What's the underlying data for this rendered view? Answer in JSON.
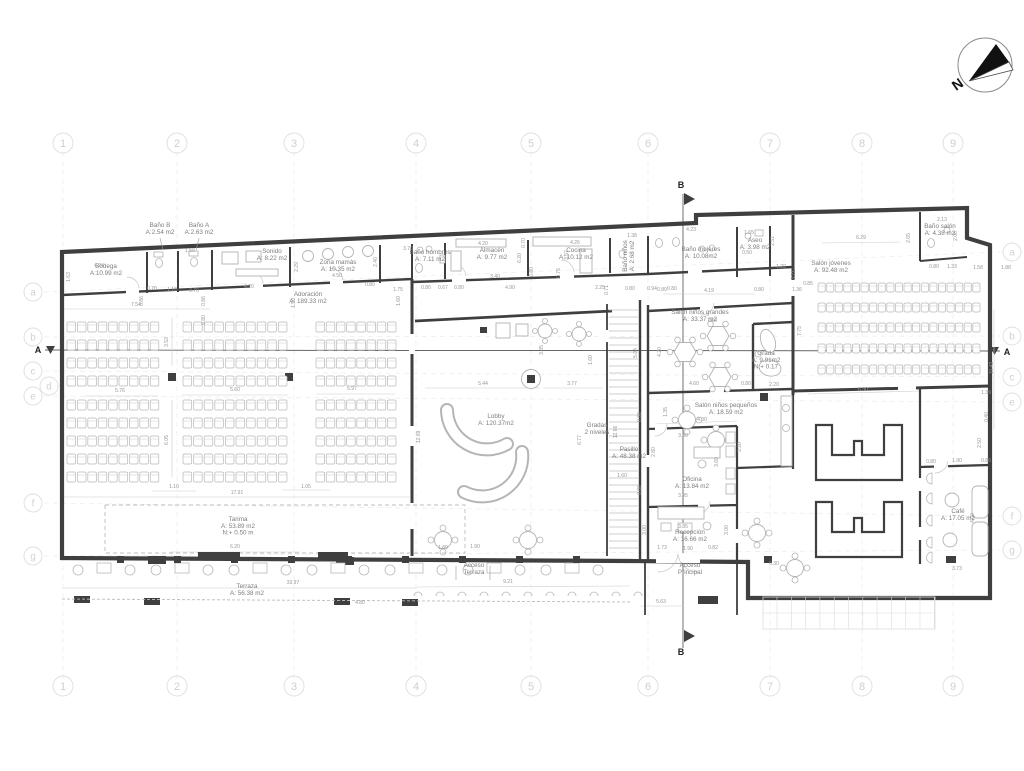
{
  "meta": {
    "wall_color": "#3f3f3f",
    "furniture_color": "#b3b3b3",
    "label_color": "#7d7d7d",
    "dimension_color": "#969696",
    "grid_color": "#e9e9e9"
  },
  "compass": {
    "label": "N"
  },
  "sections": {
    "a": "A",
    "b": "B"
  },
  "grid": {
    "columns": [
      {
        "n": "1",
        "x": 63
      },
      {
        "n": "2",
        "x": 177
      },
      {
        "n": "3",
        "x": 294
      },
      {
        "n": "4",
        "x": 416
      },
      {
        "n": "5",
        "x": 531
      },
      {
        "n": "6",
        "x": 648
      },
      {
        "n": "7",
        "x": 770
      },
      {
        "n": "8",
        "x": 862
      },
      {
        "n": "9",
        "x": 953
      }
    ],
    "rows": [
      {
        "n": "a",
        "yl": 292,
        "yr": 252,
        "right": true
      },
      {
        "n": "b",
        "yl": 337,
        "yr": 336,
        "right": true
      },
      {
        "n": "c",
        "yl": 371,
        "yr": 377,
        "right": true
      },
      {
        "n": "d",
        "yl": 386,
        "xl": 49,
        "right": false
      },
      {
        "n": "e",
        "yl": 396,
        "yr": 402,
        "right": true
      },
      {
        "n": "f",
        "yl": 503,
        "yr": 516,
        "right": true
      },
      {
        "n": "g",
        "yl": 556,
        "yr": 550,
        "right": true
      }
    ]
  },
  "rooms": [
    {
      "name": "Bodega",
      "area": "A:10.99 m2",
      "x": 106,
      "y": 268
    },
    {
      "name": "Baño B",
      "area": "A:2.54 m2",
      "x": 160,
      "y": 227
    },
    {
      "name": "Baño A",
      "area": "A:2.63 m2",
      "x": 199,
      "y": 227
    },
    {
      "name": "Sonido",
      "area": "A: 8.22 m2",
      "x": 272,
      "y": 253
    },
    {
      "name": "Zona mamás",
      "area": "A: 10.35 m2",
      "x": 338,
      "y": 264
    },
    {
      "name": "Adoración",
      "area": "A: 189.33 m2",
      "x": 308,
      "y": 296
    },
    {
      "name": "Baño hombres",
      "area": "A: 7.11 m2",
      "x": 430,
      "y": 254
    },
    {
      "name": "Almacén",
      "area": "A: 9.77 m2",
      "x": 492,
      "y": 252
    },
    {
      "name": "Cocina",
      "area": "A: 10.12 m2",
      "x": 576,
      "y": 252
    },
    {
      "name": "Baño niños",
      "area": "A: 2.68 m2",
      "x": 627,
      "y": 256,
      "r": 1
    },
    {
      "name": "Baño mujeres",
      "area": "A: 10.08m2",
      "x": 701,
      "y": 251
    },
    {
      "name": "Aseo",
      "area": "A: 3.98 m2",
      "x": 755,
      "y": 242
    },
    {
      "name": "Salón jóvenes",
      "area": "A: 92.48 m2",
      "x": 831,
      "y": 265
    },
    {
      "name": "Baño salón",
      "area": "A: 4.38 m2",
      "x": 940,
      "y": 228
    },
    {
      "name": "Salón niños grandes",
      "area": "A: 33.37 m2",
      "x": 700,
      "y": 314
    },
    {
      "name": "Grada",
      "area": "A: 9.91m2",
      "level": "N:+ 0.17",
      "x": 766,
      "y": 355
    },
    {
      "name": "Salón niños pequeños",
      "area": "A: 18.59 m2",
      "x": 726,
      "y": 407
    },
    {
      "name": "Lobby",
      "area": "A: 120.37m2",
      "x": 496,
      "y": 418
    },
    {
      "name": "Gradas\n2 niveles",
      "x": 597,
      "y": 427
    },
    {
      "name": "Pasillo",
      "area": "A: 48.38 m2",
      "x": 629,
      "y": 451
    },
    {
      "name": "Oficina",
      "area": "A: 13.84 m2",
      "x": 692,
      "y": 481
    },
    {
      "name": "Recepción",
      "area": "A: 16.66 m2",
      "x": 690,
      "y": 534
    },
    {
      "name": "Acceso\nPrincipal",
      "x": 690,
      "y": 567
    },
    {
      "name": "Café",
      "area": "A: 17.05 m2",
      "x": 958,
      "y": 513
    },
    {
      "name": "Terraza",
      "area": "A: 56.38 m2",
      "x": 247,
      "y": 588
    },
    {
      "name": "Acceso\nTerraza",
      "x": 474,
      "y": 567
    },
    {
      "name": "Tarima",
      "area": "A: 53.89 m2",
      "level": "N:+ 0.50 m",
      "x": 238,
      "y": 521
    }
  ],
  "dimensions": [
    {
      "t": "1.63",
      "x": 70,
      "y": 277,
      "r": 1
    },
    {
      "t": "4.24",
      "x": 99,
      "y": 267
    },
    {
      "t": "7.54",
      "x": 136,
      "y": 306
    },
    {
      "t": "1.50",
      "x": 190,
      "y": 252
    },
    {
      "t": "0.70",
      "x": 152,
      "y": 290
    },
    {
      "t": "1.10",
      "x": 172,
      "y": 291
    },
    {
      "t": "0.70",
      "x": 194,
      "y": 292
    },
    {
      "t": "0.86",
      "x": 143,
      "y": 301,
      "r": 1
    },
    {
      "t": "0.86",
      "x": 205,
      "y": 301,
      "r": 1
    },
    {
      "t": "4.20",
      "x": 249,
      "y": 288
    },
    {
      "t": "2.29",
      "x": 298,
      "y": 267,
      "r": 1
    },
    {
      "t": "4.50",
      "x": 337,
      "y": 277
    },
    {
      "t": "2.40",
      "x": 377,
      "y": 262,
      "r": 1
    },
    {
      "t": "0.80",
      "x": 370,
      "y": 286
    },
    {
      "t": "1.50",
      "x": 295,
      "y": 303,
      "r": 1
    },
    {
      "t": "3.70",
      "x": 408,
      "y": 250
    },
    {
      "t": "1.60",
      "x": 400,
      "y": 301,
      "r": 1
    },
    {
      "t": "1.75",
      "x": 398,
      "y": 291
    },
    {
      "t": "0.80",
      "x": 426,
      "y": 289
    },
    {
      "t": "0.67",
      "x": 443,
      "y": 289
    },
    {
      "t": "0.80",
      "x": 459,
      "y": 289
    },
    {
      "t": "4.20",
      "x": 483,
      "y": 245
    },
    {
      "t": "0.70",
      "x": 525,
      "y": 243,
      "r": 1
    },
    {
      "t": "4.26",
      "x": 575,
      "y": 244
    },
    {
      "t": "6.20",
      "x": 521,
      "y": 258,
      "r": 1
    },
    {
      "t": "3.40",
      "x": 495,
      "y": 278
    },
    {
      "t": "0.80",
      "x": 533,
      "y": 272,
      "r": 1
    },
    {
      "t": "0.75",
      "x": 560,
      "y": 273,
      "r": 1
    },
    {
      "t": "4.90",
      "x": 510,
      "y": 289
    },
    {
      "t": "2.25",
      "x": 600,
      "y": 289
    },
    {
      "t": "3.57",
      "x": 568,
      "y": 255,
      "r": 1
    },
    {
      "t": "1.38",
      "x": 632,
      "y": 237
    },
    {
      "t": "0.71",
      "x": 608,
      "y": 290,
      "r": 1
    },
    {
      "t": "0.80",
      "x": 630,
      "y": 290
    },
    {
      "t": "0.94",
      "x": 652,
      "y": 290
    },
    {
      "t": "0.80",
      "x": 672,
      "y": 290
    },
    {
      "t": "4.23",
      "x": 691,
      "y": 231
    },
    {
      "t": "1.65",
      "x": 749,
      "y": 234
    },
    {
      "t": "0.50",
      "x": 747,
      "y": 254
    },
    {
      "t": "2.51",
      "x": 774,
      "y": 241,
      "r": 1
    },
    {
      "t": "1.20",
      "x": 781,
      "y": 268
    },
    {
      "t": "3.21",
      "x": 795,
      "y": 275,
      "r": 1
    },
    {
      "t": "1.36",
      "x": 797,
      "y": 291
    },
    {
      "t": "0.85",
      "x": 808,
      "y": 285
    },
    {
      "t": "0.80",
      "x": 662,
      "y": 291
    },
    {
      "t": "4.19",
      "x": 709,
      "y": 292
    },
    {
      "t": "0.80",
      "x": 759,
      "y": 291
    },
    {
      "t": "6.29",
      "x": 861,
      "y": 239
    },
    {
      "t": "2.65",
      "x": 910,
      "y": 238,
      "r": 1
    },
    {
      "t": "2.13",
      "x": 942,
      "y": 221
    },
    {
      "t": "2.06",
      "x": 957,
      "y": 236,
      "r": 1
    },
    {
      "t": "0.80",
      "x": 934,
      "y": 268
    },
    {
      "t": "1.33",
      "x": 952,
      "y": 268
    },
    {
      "t": "1.58",
      "x": 978,
      "y": 269
    },
    {
      "t": "1.88",
      "x": 1006,
      "y": 269
    },
    {
      "t": "7.75",
      "x": 801,
      "y": 331,
      "r": 1
    },
    {
      "t": "10.42",
      "x": 993,
      "y": 368,
      "r": 1
    },
    {
      "t": "1.39",
      "x": 986,
      "y": 394
    },
    {
      "t": "0.40",
      "x": 988,
      "y": 417,
      "r": 1
    },
    {
      "t": "2.50",
      "x": 981,
      "y": 443,
      "r": 1
    },
    {
      "t": "0.86",
      "x": 986,
      "y": 462
    },
    {
      "t": "0.80",
      "x": 931,
      "y": 463
    },
    {
      "t": "1.90",
      "x": 957,
      "y": 462
    },
    {
      "t": "4.60",
      "x": 974,
      "y": 518,
      "r": 1
    },
    {
      "t": "3.73",
      "x": 957,
      "y": 570
    },
    {
      "t": "7.60",
      "x": 712,
      "y": 322
    },
    {
      "t": "4.20",
      "x": 661,
      "y": 352,
      "r": 1
    },
    {
      "t": "5.04",
      "x": 637,
      "y": 353,
      "r": 1
    },
    {
      "t": "4.60",
      "x": 694,
      "y": 385
    },
    {
      "t": "0.80",
      "x": 746,
      "y": 385
    },
    {
      "t": "2.20",
      "x": 774,
      "y": 386
    },
    {
      "t": "6.30",
      "x": 863,
      "y": 391
    },
    {
      "t": "1.35",
      "x": 667,
      "y": 412,
      "r": 1
    },
    {
      "t": "5.44",
      "x": 483,
      "y": 385
    },
    {
      "t": "3.77",
      "x": 572,
      "y": 385
    },
    {
      "t": "3.85",
      "x": 543,
      "y": 350,
      "r": 1
    },
    {
      "t": "1.60",
      "x": 592,
      "y": 360,
      "r": 1
    },
    {
      "t": "12.66",
      "x": 617,
      "y": 432,
      "r": 1
    },
    {
      "t": "6.77",
      "x": 581,
      "y": 440,
      "r": 1
    },
    {
      "t": "12.09",
      "x": 420,
      "y": 437,
      "r": 1
    },
    {
      "t": "4.00",
      "x": 702,
      "y": 421
    },
    {
      "t": "3.80",
      "x": 683,
      "y": 437
    },
    {
      "t": "2.80",
      "x": 655,
      "y": 452,
      "r": 1
    },
    {
      "t": "3.60",
      "x": 718,
      "y": 462,
      "r": 1
    },
    {
      "t": "2.20",
      "x": 741,
      "y": 447,
      "r": 1
    },
    {
      "t": "3.95",
      "x": 683,
      "y": 497
    },
    {
      "t": "1.60",
      "x": 622,
      "y": 477
    },
    {
      "t": "0.80",
      "x": 641,
      "y": 417,
      "r": 1
    },
    {
      "t": "0.80",
      "x": 641,
      "y": 490,
      "r": 1
    },
    {
      "t": "3.00",
      "x": 646,
      "y": 530,
      "r": 1
    },
    {
      "t": "3.00",
      "x": 728,
      "y": 530,
      "r": 1
    },
    {
      "t": "3.85",
      "x": 683,
      "y": 528
    },
    {
      "t": "1.73",
      "x": 662,
      "y": 549
    },
    {
      "t": "1.90",
      "x": 688,
      "y": 550
    },
    {
      "t": "0.82",
      "x": 713,
      "y": 549
    },
    {
      "t": "0.30",
      "x": 774,
      "y": 565
    },
    {
      "t": "5.63",
      "x": 661,
      "y": 603
    },
    {
      "t": "3.53",
      "x": 168,
      "y": 342,
      "r": 1
    },
    {
      "t": "0.80",
      "x": 205,
      "y": 320,
      "r": 1
    },
    {
      "t": "5.76",
      "x": 120,
      "y": 392
    },
    {
      "t": "5.60",
      "x": 235,
      "y": 391
    },
    {
      "t": "5.97",
      "x": 352,
      "y": 390
    },
    {
      "t": "6.05",
      "x": 168,
      "y": 440,
      "r": 1
    },
    {
      "t": "1.10",
      "x": 174,
      "y": 488
    },
    {
      "t": "1.05",
      "x": 306,
      "y": 488
    },
    {
      "t": "17.91",
      "x": 237,
      "y": 494
    },
    {
      "t": "6.20",
      "x": 235,
      "y": 548
    },
    {
      "t": "33.97",
      "x": 293,
      "y": 584
    },
    {
      "t": "4.80",
      "x": 360,
      "y": 604
    },
    {
      "t": "1.89",
      "x": 443,
      "y": 549
    },
    {
      "t": "1.90",
      "x": 475,
      "y": 548
    },
    {
      "t": "9.21",
      "x": 508,
      "y": 583
    }
  ]
}
